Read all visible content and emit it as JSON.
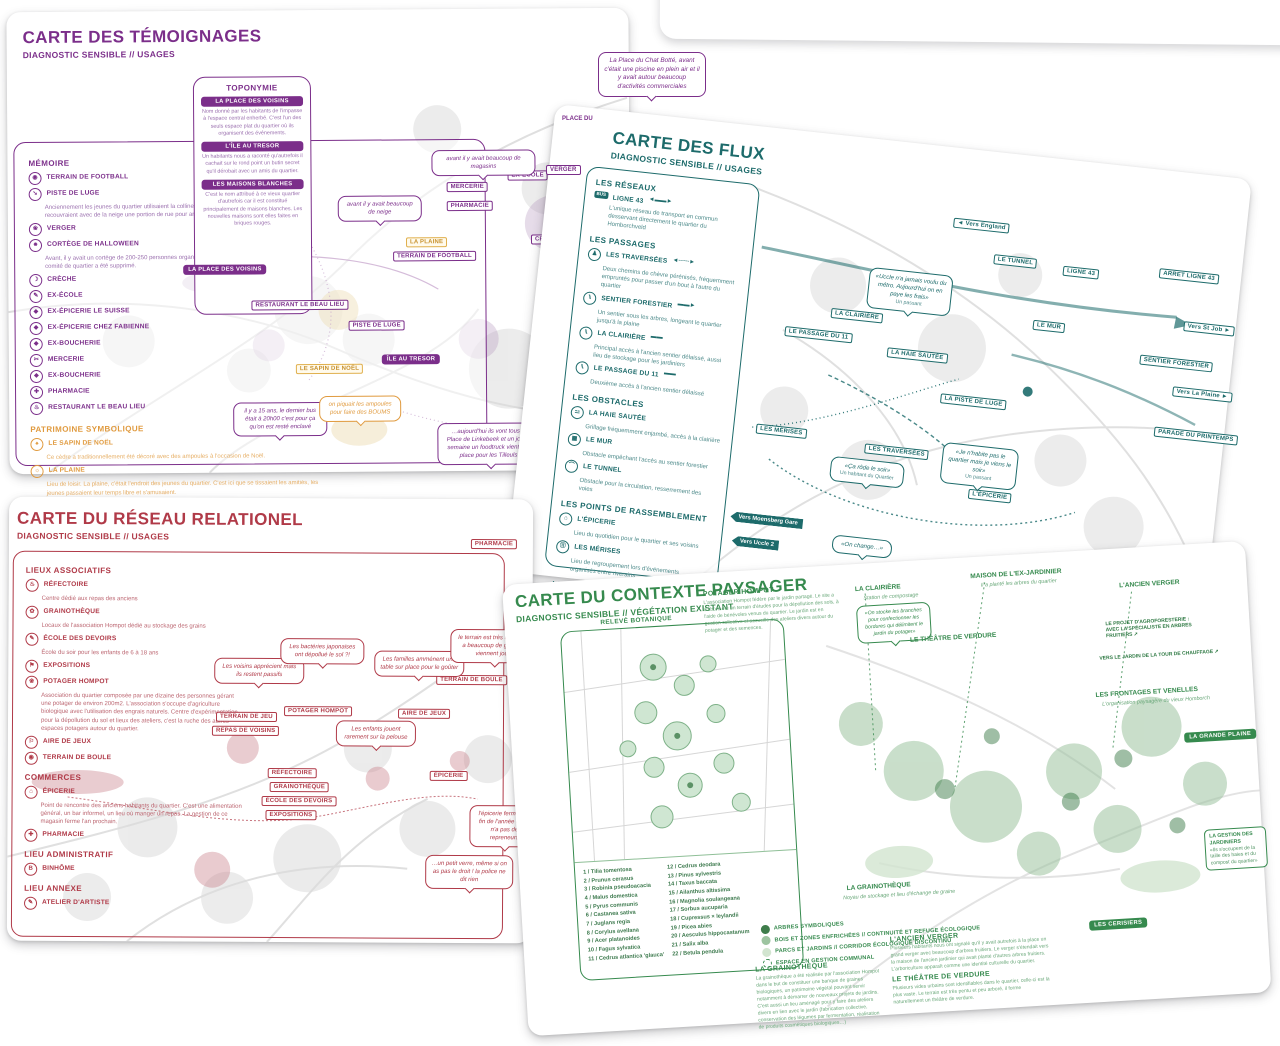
{
  "temoignages": {
    "title": "CARTE DES TÉMOIGNAGES",
    "subtitle": "DIAGNOSTIC SENSIBLE // USAGES",
    "memoire": {
      "heading": "MÉMOIRE",
      "items": [
        {
          "icon": "football-icon",
          "glyph": "◉",
          "label": "TERRAIN DE FOOTBALL",
          "desc": ""
        },
        {
          "icon": "sled-icon",
          "glyph": "➘",
          "label": "PISTE DE LUGE",
          "desc": "Anciennement les jeunes du quartier utilisaient la colline enneigée comme piste de luge. Les jeunes recouvraient avec de la neige une portion de rue pour arriver plus loin."
        },
        {
          "icon": "orchard-icon",
          "glyph": "❀",
          "label": "VERGER",
          "desc": ""
        },
        {
          "icon": "mask-icon",
          "glyph": "☻",
          "label": "CORTÈGE DE HALLOWEEN",
          "desc": "Avant, il y avait un cortège de 200-250 personnes organisé par le comité de quartier. Depuis 3 ans le comité de quartier a été supprimé."
        },
        {
          "icon": "cradle-icon",
          "glyph": "☽",
          "label": "CRÈCHE",
          "desc": ""
        },
        {
          "icon": "pencil-icon",
          "glyph": "✎",
          "label": "EX-ÉCOLE",
          "desc": ""
        },
        {
          "icon": "shop-icon",
          "glyph": "◆",
          "label": "EX-ÉPICERIE LE SUISSE",
          "desc": ""
        },
        {
          "icon": "shop-icon",
          "glyph": "◆",
          "label": "EX-ÉPICERIE CHEZ FABIENNE",
          "desc": ""
        },
        {
          "icon": "shop-icon",
          "glyph": "◆",
          "label": "EX-BOUCHERIE",
          "desc": ""
        },
        {
          "icon": "scissors-icon",
          "glyph": "✂",
          "label": "MERCERIE",
          "desc": ""
        },
        {
          "icon": "shop-icon",
          "glyph": "◆",
          "label": "EX-BOUCHERIE",
          "desc": ""
        },
        {
          "icon": "cross-icon",
          "glyph": "✚",
          "label": "PHARMACIE",
          "desc": ""
        },
        {
          "icon": "restaurant-icon",
          "glyph": "♨",
          "label": "RESTAURANT LE BEAU LIEU",
          "desc": ""
        }
      ]
    },
    "patrimoine": {
      "heading": "PATRIMOINE SYMBOLIQUE",
      "items": [
        {
          "icon": "tree-icon",
          "glyph": "♠",
          "label": "LE SAPIN DE NOËL",
          "desc": "Ce cèdre a traditionnellement été décoré avec des ampoules à l'occasion de Noël."
        },
        {
          "icon": "sun-icon",
          "glyph": "☼",
          "label": "LA PLAINE",
          "desc": "Lieu de loisir. La plaine, c'était l'endroit des jeunes du quartier. C'est ici que se tissaient les amitiés, les jeunes passaient leur temps libre et s'amusaient."
        }
      ]
    },
    "toponymie": {
      "heading": "TOPONYMIE",
      "entries": [
        {
          "tag": "LA PLACE DES VOISINS",
          "text": "Nom donné par les habitants de l'impasse à l'espace central enherbé. C'est l'un des seuls espace plat du quartier où ils organisent des événements."
        },
        {
          "tag": "L'ÎLE AU TRESOR",
          "text": "Un habitants nous a raconté qu'autrefois il cachait sur le rond point un butin secret qu'il dérobait avec un amis du quartier."
        },
        {
          "tag": "LES MAISONS BLANCHES",
          "text": "C'est le nom attribué à ce vieux quartier d'autrefois car il est constitué principalement de maisons blanches. Les nouvelles maisons sont elles faites en briques rouges."
        }
      ]
    },
    "labels": {
      "mercerie": "MERCERIE",
      "pharmacie": "PHARMACIE",
      "ex_ecole": "EX-ÉCOLE",
      "creche": "CRÈCHE",
      "la_plaine": "LA PLAINE",
      "terrain_football": "TERRAIN DE FOOTBALL",
      "place_voisins": "LA PLACE DES VOISINS",
      "restaurant": "RESTAURANT LE BEAU LIEU",
      "piste_luge": "PISTE DE LUGE",
      "ile_tresor": "ÎLE AU TRESOR",
      "sapin": "LE SAPIN DE NOËL",
      "ex_epicerie": "EX-ÉPICERIE CHEZ…",
      "place_du": "PLACE DU",
      "verger": "VERGER"
    },
    "bubbles": [
      "avant il y avait beaucoup de magasins",
      "avant il y avait beaucoup de neige",
      "il y a trois ans les étudiants d'Uccle 2 venaient manger un sandwich ici à midi!",
      "il y a 15 ans, le dernier bus était à 20h00 c'est pour ça qu'on est resté enclavé",
      "on piquait les ampoules pour faire des BOUMS",
      "…aujourd'hui ils vont tous à la Place de Linkebeek et un jour par semaine un foodtruck vient sur la place pour les Tilleuls…",
      "…il y a beaucoup de convivialité, les jeunes se retrouvent ici…",
      "La Place du Chat Botté, avant c'était une piscine en plein air et il y avait autour beaucoup d'activités commerciales"
    ]
  },
  "flux": {
    "title": "CARTE DES FLUX",
    "subtitle": "DIAGNOSTIC SENSIBLE // USAGES",
    "sections": {
      "reseaux": {
        "heading": "LES RÉSEAUX",
        "items": [
          {
            "glyph": "BUS",
            "label": "LIGNE 43",
            "arrow": "◄▬▬►",
            "desc": "L'unique réseau de transport en commun desservant directement le quartier du Homborchveld"
          }
        ]
      },
      "passages": {
        "heading": "LES PASSAGES",
        "items": [
          {
            "glyph": "♟",
            "label": "LES TRAVERSÉES",
            "arrow": "◄╌╌╌►",
            "desc": "Deux chemins de chèvre pérénisés, fréquemment empruntés pour passer d'un bout à l'autre du quartier"
          },
          {
            "glyph": "⑊",
            "label": "SENTIER FORESTIER",
            "arrow": "▬▬►",
            "desc": "Un sentier sous les arbres, longeant le quartier jusqu'à la plaine"
          },
          {
            "glyph": "⑊",
            "label": "LA CLAIRIÈRE",
            "arrow": "▬▬",
            "desc": "Principal accès à l'ancien sentier délaissé, aussi lieu de stockage pour les jardiniers"
          },
          {
            "glyph": "⑊",
            "label": "LE PASSAGE DU 11",
            "arrow": "▬▬",
            "desc": "Deuxième accès à l'ancien sentier délaissé"
          }
        ]
      },
      "obstacles": {
        "heading": "LES OBSTACLES",
        "items": [
          {
            "glyph": "⚍",
            "label": "LA HAIE SAUTÉE",
            "arrow": "",
            "desc": "Grillage fréquemment enjambé, accès à la clairière"
          },
          {
            "glyph": "▦",
            "label": "LE MUR",
            "arrow": "",
            "desc": "Obstacle empêchant l'accès au sentier forestier"
          },
          {
            "glyph": "⌒",
            "label": "LE TUNNEL",
            "arrow": "",
            "desc": "Obstacle pour la circulation, resserrement des voies"
          }
        ]
      },
      "rassemblement": {
        "heading": "LES POINTS DE RASSEMBLEMENT",
        "items": [
          {
            "glyph": "⌂",
            "label": "L'ÉPICERIE",
            "arrow": "",
            "desc": "Lieu du quotidien pour le quartier et ses voisins"
          },
          {
            "glyph": "⑪",
            "label": "LES MÉRISES",
            "arrow": "",
            "desc": "Lieu de regroupement lors d'événements organisés entre riverains"
          }
        ]
      },
      "evenementiels": {
        "heading": "LES FLUX ÉVÉNEMENTIELS",
        "items": [
          {
            "glyph": "✿",
            "label": "PARADE DU PRINTEMPS",
            "arrow": "",
            "desc": "L'événement le plus important du quartier"
          },
          {
            "glyph": "➘",
            "label": "LA PISTE DE LUGE",
            "arrow": "",
            "desc": "tracé saisonnier dessiné par les enfants"
          }
        ]
      },
      "annexes": {
        "heading": "LES LIEUX ANNEXES",
        "tags": [
          "Vers Moensberg Gare",
          "Vers Linkebeek Gare"
        ],
        "desc": "Les deux gares les plus proches du quartier, permettant l'accès au centre de Bruxelles"
      }
    },
    "labels": {
      "vers_england": "◄ Vers England",
      "tunnel": "LE TUNNEL",
      "ligne43": "LIGNE 43",
      "arret": "ARRET LIGNE 43",
      "st_job": "Vers St Job ►",
      "mur": "LE MUR",
      "clairiere": "LA CLAIRIÈRE",
      "passage11": "LE PASSAGE DU 11",
      "haie": "LA HAIE SAUTÉE",
      "sentier": "SENTIER FORESTIER",
      "plaine": "Vers La Plaine ►",
      "piste": "LA PISTE DE LUGE",
      "merises": "LES MÉRISES",
      "traversees": "LES TRAVERSÉES",
      "epicerie": "L'ÉPICERIE",
      "parade": "PARADE DU PRINTEMPS",
      "moensberg": "Vers Moensberg Gare",
      "uccle2": "Vers Uccle 2"
    },
    "bubbles": [
      {
        "text": "«Uccle n'a jamais voulu du métro. Aujourd'hui on en paye les frais»",
        "src": "Un passant"
      },
      {
        "text": "«Ça rôde le soir»",
        "src": "Un habitant du Quartier"
      },
      {
        "text": "«Je n'habite pas le quartier mais je viens le soir»",
        "src": "Un passant"
      },
      {
        "text": "«On change…»",
        "src": ""
      }
    ]
  },
  "reseau": {
    "title": "CARTE DU RÉSEAU RELATIONEL",
    "subtitle": "DIAGNOSTIC SENSIBLE // USAGES",
    "sections": {
      "associatifs": {
        "heading": "LIEUX ASSOCIATIFS",
        "items": [
          {
            "glyph": "♨",
            "icon": "canteen-icon",
            "label": "RÉFECTOIRE",
            "desc": "Centre dédié aux repas des anciens"
          },
          {
            "glyph": "✿",
            "icon": "seed-icon",
            "label": "GRAINOTHÈQUE",
            "desc": "Locaux de l'association Hompot dédié au stockage des grains"
          },
          {
            "glyph": "✎",
            "icon": "pencil-icon",
            "label": "ÉCOLE DES DEVOIRS",
            "desc": "École du soir pour les enfants de 6 à 18 ans"
          },
          {
            "glyph": "⚑",
            "icon": "expo-icon",
            "label": "EXPOSITIONS",
            "desc": ""
          },
          {
            "glyph": "❀",
            "icon": "garden-icon",
            "label": "POTAGER HOMPOT",
            "desc": "Association du quartier composée par une dizaine des personnes gérant une potager de environ 200m2. L'association s'occupe d'agriculture biologique avec l'utilisation des engrais naturels. Centre d'expérimentation pour la dépollution du sol et lieux des ateliers, c'est la ruche des autres espaces potagers autour du quartier."
          },
          {
            "glyph": "⚐",
            "icon": "playground-icon",
            "label": "AIRE DE JEUX",
            "desc": ""
          },
          {
            "glyph": "◉",
            "icon": "petanque-icon",
            "label": "TERRAIN DE BOULE",
            "desc": ""
          }
        ]
      },
      "commerces": {
        "heading": "COMMERCES",
        "items": [
          {
            "glyph": "⌂",
            "icon": "shop-icon",
            "label": "ÉPICERIE",
            "desc": "Point de rencontre des anciens habitants du quartier. C'est une alimentation général, un bar informel, un lieu où manger un repas. La gestion de ce magasin ferme l'an prochain."
          },
          {
            "glyph": "✚",
            "icon": "cross-icon",
            "label": "PHARMACIE",
            "desc": ""
          }
        ]
      },
      "administratif": {
        "heading": "LIEU ADMINISTRATIF",
        "items": [
          {
            "glyph": "B",
            "icon": "office-icon",
            "label": "BINHÔME",
            "desc": ""
          }
        ]
      },
      "annexe": {
        "heading": "LIEU ANNEXE",
        "items": [
          {
            "glyph": "✎",
            "icon": "atelier-icon",
            "label": "ATELIER D'ARTISTE",
            "desc": ""
          }
        ]
      }
    },
    "labels": {
      "pharmacie": "PHARMACIE",
      "terrain_jeu": "TERRAIN DE JEU",
      "repas": "REPAS DE VOISINS",
      "potager": "POTAGER HOMPOT",
      "aire": "AIRE DE JEUX",
      "boule": "TERRAIN DE BOULE",
      "refectoire": "RÉFECTOIRE",
      "graino": "GRAINOTHÈQUE",
      "ecole": "ÉCOLE DES DEVOIRS",
      "expos": "EXPOSITIONS",
      "epicerie": "ÉPICERIE"
    },
    "bubbles": [
      "Les voisins apprécient mais ils restent passifs",
      "Les bactéries japonaises ont dépollué le sol ?!",
      "Les familles amménent une table sur place pour le goûter",
      "le terrain est très utilisé, il y a beaucoup de gens qui viennent jouer",
      "Les enfants jouent rarement sur la pelouse",
      "l'épicerie ferme à la fin de l'année et il y n'a pas de repreneurs",
      "…un petit verre, même si on as pas le droit ! la police ne dit rien"
    ]
  },
  "paysager": {
    "title": "CARTE DU CONTEXTE PAYSAGER",
    "subtitle": "DIAGNOSTIC SENSIBLE // VÉGÉTATION EXISTANT",
    "releve_heading": "RELEVÉ BOTANIQUE",
    "potager": {
      "heading": "POTAGER HOMPOT",
      "text": "L'association Hompot fédère par le jardin partagé. Le site a d'abord été un terrain d'études pour la dépollution des sols, à l'aide de bénévoles venus du quartier. Le jardin est en gestion collective et accueille des ateliers divers autour du potager et des semences."
    },
    "species": {
      "col1": [
        "1 / Tilia tomentosa",
        "2 / Prunus cerasus",
        "3 / Robinia pseudoacacia",
        "4 / Malus domestica",
        "5 / Pyrus communis",
        "6 / Castanea sativa",
        "7 / Juglans regia",
        "8 / Corylus avellana",
        "9 / Acer platanoides",
        "10 / Fagus sylvatica",
        "11 / Cedrus atlantica 'glauca'"
      ],
      "col2": [
        "12 / Cedrus deodara",
        "13 / Pinus sylvestris",
        "14 / Taxus baccata",
        "15 / Ailanthus altissima",
        "16 / Magnolia soulangeana",
        "17 / Sorbus aucuparia",
        "18 / Cupressus × leylandii",
        "19 / Picea abies",
        "20 / Aesculus hippocastanum",
        "21 / Salix alba",
        "22 / Betula pendula"
      ]
    },
    "categories": [
      {
        "label": "ARBRES SYMBOLIQUES",
        "color": "#3f7d4b"
      },
      {
        "label": "BOIS ET ZONES ENFRICHÉES // CONTINUITÉ ET REFUGE ÉCOLOGIQUE",
        "color": "#9dc4a0"
      },
      {
        "label": "PARCS ET JARDINS // CORRIDOR ÉCOLOGIQUE DISCONTINU",
        "color": "#d2e5d0"
      },
      {
        "label": "ESPACE EN GESTION COMMUNAL",
        "color": "dashed"
      }
    ],
    "blocks": {
      "grainotheque": {
        "heading": "LA GRAINOTHÈQUE",
        "text": "La grainothèque a été réalisée par l'association Hompot dans le but de constituer une banque de graines biologiques, un patrimoine végétal pouvant servir notamment à démarrer de nouveaux projets de jardins. C'est aussi un lieu aménagé pour y faire des ateliers divers en lien avec le jardin (fabrication collective, conservation des légumes par fermentation, réalisation de produits cosmétiques biologiques…)"
      },
      "verger": {
        "heading": "L'ANCIEN VERGER",
        "text": "Plusieurs habitants nous ont signalé qu'il y avait autrefois à la place un grand verger avec beaucoup d'arbres fruitiers. Le verger s'étendait vers la maison de l'ancien jardinier qui avait planté d'autres arbres fruitiers. L'arboriculture apparaît comme une identité culturelle du quartier."
      },
      "theatre": {
        "heading": "LE THÉÂTRE DE VERDURE",
        "text": "Plusieurs vides urbains sont identifiables dans le quartier, celle-ci est la plus vaste. Le terrain est très pentu et peu arboré, il forme naturellement un théâtre de verdure."
      }
    },
    "labels": {
      "clairiere": "LA CLAIRIÈRE",
      "clairiere_sub": "Station de compostage",
      "maison": "MAISON DE L'EX-JARDINIER",
      "maison_sub": "Il a planté les arbres du quartier",
      "verger_top": "L'ANCIEN VERGER",
      "theatre": "LE THÉÂTRE DE VERDURE",
      "agro": "LE PROJET D'AGROFORESTERIE : AVEC LA SPÉCIALISTE EN ARBRES FRUITIERS ➚",
      "chauffage": "VERS LE JARDIN DE LA TOUR DE CHAUFFAGE ➚",
      "frontages": "LES FRONTAGES ET VENELLES",
      "frontages_sub": "L'organisation paysagère du vieux Homborch",
      "grande_plaine": "LA GRANDE PLAINE",
      "graino": "LA GRAINOTHÈQUE",
      "graino_sub": "Noyau de stockage et lieu d'échange de graine",
      "cerisiers": "LES CERISIERS",
      "gestion": "LA GESTION DES JARDINIERS",
      "gestion_text": "«Ils s'occupent de la taille des haies et du compost du quartier»"
    },
    "bubble_clairiere": "«On stocke les branches pour confectionner les bordures qui délimitent le jardin du potager»"
  }
}
